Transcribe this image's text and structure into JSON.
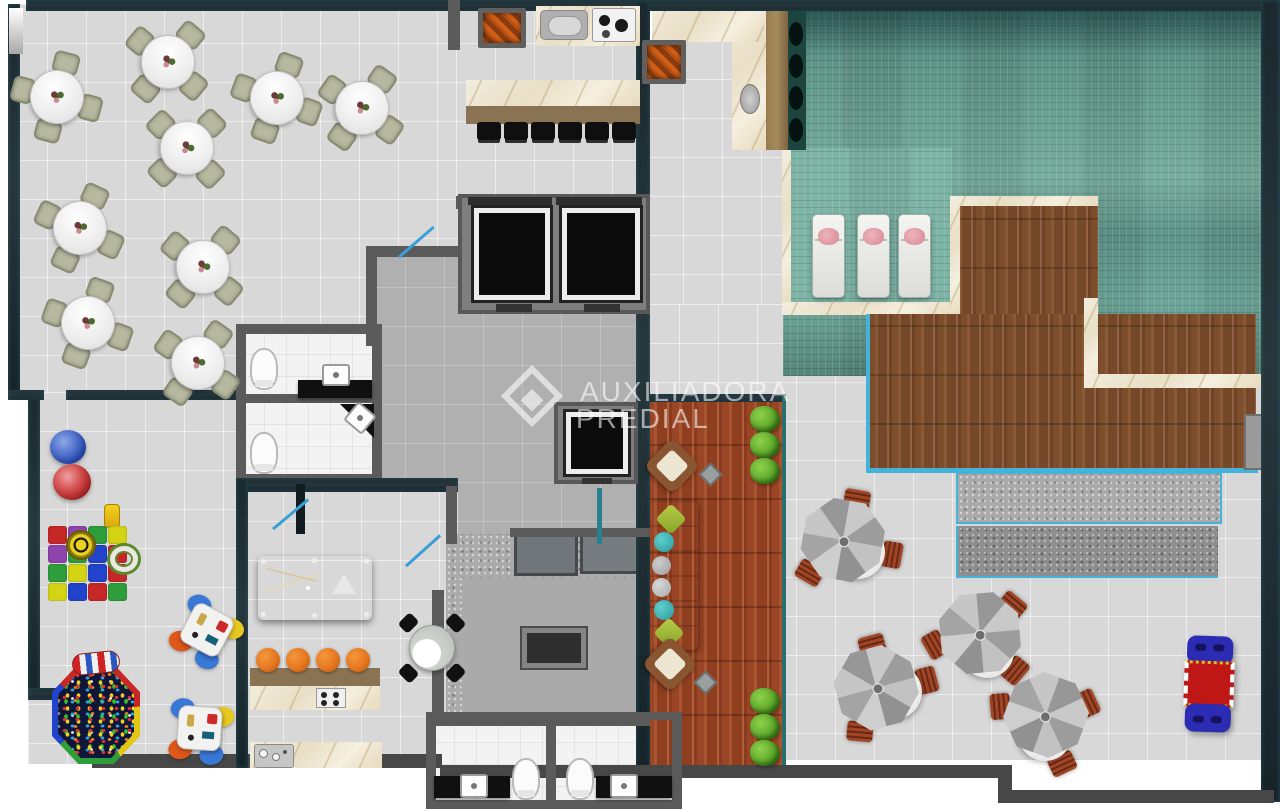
{
  "watermark": {
    "brand_line1": "AUXILIADORA",
    "brand_line2": "PREDIAL",
    "logo": "diamond-logo"
  },
  "palette": {
    "wall_gray": "#5b5b5b",
    "floor_light": "#d8d8d8",
    "floor_hall": "#b0b0b0",
    "white_tile": "#f3f3f3",
    "pool_teal": "#679e91",
    "cyan": "#45b3d9",
    "blue_door": "#3a9fd6",
    "felt_red": "#c2203c",
    "chair_tan": "#b6b99f",
    "brown_chair": "#a34424",
    "counter_wood": "#8a7352",
    "watermark": "rgba(255,255,255,0.58)"
  },
  "scene": {
    "party_room": {
      "dining_tables_count": 9,
      "table_positions": [
        [
          57,
          97
        ],
        [
          168,
          62
        ],
        [
          277,
          98
        ],
        [
          362,
          108
        ],
        [
          187,
          148
        ],
        [
          80,
          228
        ],
        [
          203,
          267
        ],
        [
          88,
          323
        ],
        [
          198,
          363
        ]
      ],
      "table_rotations": [
        15,
        40,
        20,
        35,
        45,
        25,
        40,
        20,
        35
      ]
    },
    "bar": {
      "stool_count": 6,
      "stool_xs": [
        477,
        504,
        531,
        558,
        585,
        612
      ],
      "stool_y": 122
    },
    "pool": {
      "lounger_count": 3,
      "lounger_xs": [
        812,
        857,
        898
      ],
      "lounger_y": 214
    },
    "terrace": {
      "umbrella_count": 4,
      "umbrella_sets": [
        [
          848,
          545,
          10
        ],
        [
          982,
          640,
          40
        ],
        [
          883,
          690,
          -15
        ],
        [
          1045,
          722,
          65
        ]
      ]
    },
    "red_deck": {
      "bush_x": 750,
      "bush_ys": [
        406,
        432,
        458,
        688,
        714,
        740
      ]
    },
    "gourmet": {
      "stool_xs": [
        256,
        286,
        316,
        346
      ],
      "stool_y": 648
    },
    "playroom": {
      "mat_origin": [
        48,
        526
      ],
      "mat_colors": [
        [
          "#c62828",
          "#8e44ad",
          "#2e9e3a",
          "#d4d414"
        ],
        [
          "#8e44ad",
          "#2e9e3a",
          "#2244cc",
          "#c62828"
        ],
        [
          "#2e9e3a",
          "#d4d414",
          "#2244cc",
          "#c62828"
        ],
        [
          "#d4d414",
          "#2244cc",
          "#c62828",
          "#2e9e3a"
        ]
      ],
      "kid_tables": [
        [
          172,
          598,
          16
        ],
        [
          166,
          696,
          -8
        ]
      ]
    },
    "door_swings": [
      [
        398,
        256,
        -41
      ],
      [
        272,
        528,
        -40
      ],
      [
        405,
        565,
        -42
      ]
    ],
    "elevator_count": 3,
    "bathroom_count": 4
  }
}
